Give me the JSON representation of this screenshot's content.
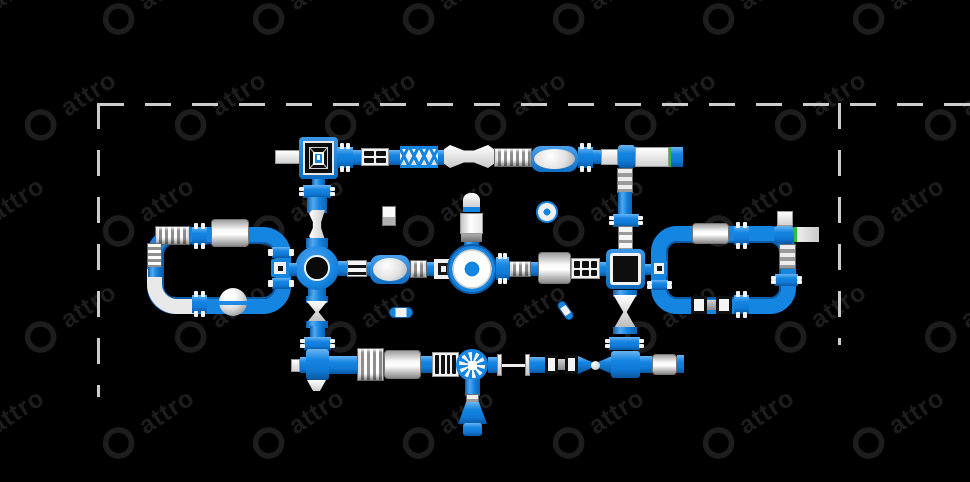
{
  "scene": {
    "width": 970,
    "height": 482,
    "background": "#000000"
  },
  "watermark": {
    "text": "attro",
    "logo_icon": "triskelion-swirl-logo",
    "color": "#1d1d1d",
    "angle_deg": -33,
    "cols": 8,
    "rows": 5,
    "tile_dx": 150,
    "tile_dy": 106,
    "row_stagger": 72,
    "start_x": -55,
    "start_y": -18,
    "font_size": 25,
    "logo_size": 36
  },
  "border": {
    "color": "#cccccc",
    "thickness": 3,
    "dash": 26,
    "gap": 21,
    "top": {
      "x": 98,
      "y": 103,
      "length": 872,
      "orientation": "h"
    },
    "left": {
      "x": 97,
      "y": 103,
      "length": 294,
      "orientation": "v"
    },
    "right": {
      "x": 838,
      "y": 103,
      "length": 242,
      "orientation": "v"
    }
  },
  "palette": {
    "blue": "#1585e2",
    "blue_dark": "#0c5ba6",
    "white": "#f2f2f2",
    "gray": "#9e9e9e",
    "black": "#000000",
    "green": "#2fbf3a"
  },
  "modules": [
    {
      "type": "loop-ring",
      "name": "left-loop-circuit",
      "x": 147,
      "y": 227,
      "w": 144,
      "h": 87,
      "r": 28
    },
    {
      "type": "elbow-white",
      "name": "left-loop-slide-elbow",
      "x": 147,
      "y": 262,
      "w": 48,
      "h": 52
    },
    {
      "type": "loop-ring",
      "name": "right-loop-circuit",
      "x": 651,
      "y": 226,
      "w": 145,
      "h": 88,
      "r": 26
    },
    {
      "type": "stub-v",
      "name": "platform-stub",
      "x": 312,
      "y": 178,
      "w": 13,
      "h": 8
    },
    {
      "type": "bumps-v",
      "name": "connector",
      "x": 303,
      "y": 185,
      "w": 28,
      "h": 13
    },
    {
      "type": "pipe-v",
      "name": "pipe",
      "x": 307,
      "y": 197,
      "w": 20,
      "h": 16
    },
    {
      "type": "bone-v",
      "name": "balance-beam",
      "x": 309,
      "y": 210,
      "w": 16,
      "h": 30
    },
    {
      "type": "pipe-v",
      "name": "pipe",
      "x": 306,
      "y": 238,
      "w": 22,
      "h": 10
    },
    {
      "type": "stub-v",
      "name": "ring-stub",
      "x": 308,
      "y": 288,
      "w": 18,
      "h": 9
    },
    {
      "type": "hourglass-v",
      "name": "twist-mini",
      "x": 306,
      "y": 296,
      "w": 22,
      "h": 32
    },
    {
      "type": "pipe-v",
      "name": "pipe",
      "x": 310,
      "y": 326,
      "w": 15,
      "h": 12
    },
    {
      "type": "bumps-v",
      "name": "connector",
      "x": 304,
      "y": 337,
      "w": 27,
      "h": 13
    },
    {
      "type": "wedge-gray",
      "name": "climb-wedge",
      "x": 617,
      "y": 168,
      "w": 16,
      "h": 25
    },
    {
      "type": "pipe-v",
      "name": "pipe",
      "x": 618,
      "y": 192,
      "w": 14,
      "h": 23
    },
    {
      "type": "bumps-v",
      "name": "connector",
      "x": 613,
      "y": 214,
      "w": 26,
      "h": 13
    },
    {
      "type": "rung-ladder",
      "name": "rung-ladder",
      "x": 618,
      "y": 226,
      "w": 15,
      "h": 26
    },
    {
      "type": "hourglass-v",
      "name": "twist-bridge",
      "x": 613,
      "y": 290,
      "w": 24,
      "h": 44
    },
    {
      "type": "bumps-v",
      "name": "connector",
      "x": 609,
      "y": 337,
      "w": 31,
      "h": 13
    },
    {
      "type": "white-box",
      "name": "exit-slide-left",
      "x": 275,
      "y": 150,
      "w": 27,
      "h": 14
    },
    {
      "type": "square-platform-net",
      "name": "climb-tower-platform",
      "x": 299,
      "y": 137,
      "w": 39,
      "h": 42
    },
    {
      "type": "bumps-h",
      "name": "connector",
      "x": 337,
      "y": 147,
      "w": 16,
      "h": 21
    },
    {
      "type": "pipe-h",
      "name": "pipe",
      "x": 353,
      "y": 150,
      "w": 8,
      "h": 15
    },
    {
      "type": "grid-box",
      "name": "ladder-2x2",
      "x": 361,
      "y": 148,
      "w": 28,
      "h": 18,
      "cols": 2,
      "rows": 2
    },
    {
      "type": "pipe-h",
      "name": "pipe",
      "x": 389,
      "y": 150,
      "w": 11,
      "h": 15
    },
    {
      "type": "truss-bridge",
      "name": "x-truss-bridge",
      "x": 400,
      "y": 146,
      "w": 38,
      "h": 22
    },
    {
      "type": "pipe-h",
      "name": "pipe",
      "x": 438,
      "y": 150,
      "w": 6,
      "h": 15
    },
    {
      "type": "bone-h",
      "name": "wave-beam",
      "x": 444,
      "y": 145,
      "w": 50,
      "h": 23
    },
    {
      "type": "striped-box",
      "name": "roller-stripes",
      "x": 494,
      "y": 148,
      "w": 38,
      "h": 19
    },
    {
      "type": "oval-pad",
      "name": "blob-pad",
      "x": 531,
      "y": 146,
      "w": 47,
      "h": 26
    },
    {
      "type": "bumps-h",
      "name": "connector",
      "x": 578,
      "y": 147,
      "w": 15,
      "h": 21
    },
    {
      "type": "pipe-h",
      "name": "pipe",
      "x": 593,
      "y": 150,
      "w": 8,
      "h": 14
    },
    {
      "type": "white-box",
      "name": "slide-wedge",
      "x": 601,
      "y": 149,
      "w": 17,
      "h": 16
    },
    {
      "type": "junction-square",
      "name": "junction-top-right",
      "x": 618,
      "y": 145,
      "w": 17,
      "h": 23
    },
    {
      "type": "white-box",
      "name": "runway-platform",
      "x": 635,
      "y": 147,
      "w": 34,
      "h": 20
    },
    {
      "type": "green-stripe",
      "name": "start-line",
      "x": 669,
      "y": 147,
      "w": 2,
      "h": 20
    },
    {
      "type": "pipe-h",
      "name": "pipe",
      "x": 671,
      "y": 147,
      "w": 12,
      "h": 20
    },
    {
      "type": "ring-junction",
      "name": "ring-junction",
      "x": 295,
      "y": 246,
      "w": 44,
      "h": 44
    },
    {
      "type": "pipe-h",
      "name": "pipe",
      "x": 338,
      "y": 261,
      "w": 9,
      "h": 15
    },
    {
      "type": "rail-box",
      "name": "double-rail",
      "x": 347,
      "y": 260,
      "w": 20,
      "h": 17
    },
    {
      "type": "pipe-h",
      "name": "pipe",
      "x": 367,
      "y": 262,
      "w": 5,
      "h": 14
    },
    {
      "type": "oval-pad",
      "name": "blob-pad-2",
      "x": 370,
      "y": 255,
      "w": 40,
      "h": 29
    },
    {
      "type": "striped-box",
      "name": "ladder-3",
      "x": 410,
      "y": 260,
      "w": 17,
      "h": 18
    },
    {
      "type": "pipe-h",
      "name": "pipe",
      "x": 427,
      "y": 262,
      "w": 7,
      "h": 14
    },
    {
      "type": "frame-box",
      "name": "square-frame",
      "x": 434,
      "y": 259,
      "w": 19,
      "h": 20
    },
    {
      "type": "pipe-h",
      "name": "pipe",
      "x": 453,
      "y": 262,
      "w": 6,
      "h": 14
    },
    {
      "type": "tower-v",
      "name": "slide-tower",
      "x": 460,
      "y": 193,
      "w": 23,
      "h": 62
    },
    {
      "type": "big-wheel-circle",
      "name": "round-spinner-platform",
      "x": 447,
      "y": 244,
      "w": 50,
      "h": 50
    },
    {
      "type": "bumps-h",
      "name": "connector",
      "x": 496,
      "y": 257,
      "w": 13,
      "h": 23
    },
    {
      "type": "striped-box",
      "name": "roller-small",
      "x": 509,
      "y": 261,
      "w": 22,
      "h": 16
    },
    {
      "type": "pipe-h",
      "name": "pipe",
      "x": 531,
      "y": 262,
      "w": 7,
      "h": 14
    },
    {
      "type": "cylinder-h",
      "name": "balance-roller",
      "x": 538,
      "y": 252,
      "w": 33,
      "h": 32
    },
    {
      "type": "grid-box",
      "name": "cargo-net-3x2",
      "x": 571,
      "y": 258,
      "w": 29,
      "h": 21,
      "cols": 3,
      "rows": 2
    },
    {
      "type": "pipe-h",
      "name": "pipe",
      "x": 600,
      "y": 262,
      "w": 7,
      "h": 14
    },
    {
      "type": "big-square-platform",
      "name": "square-platform",
      "x": 606,
      "y": 249,
      "w": 39,
      "h": 40
    },
    {
      "type": "pipe-h",
      "name": "pipe",
      "x": 645,
      "y": 264,
      "w": 7,
      "h": 11
    },
    {
      "type": "small-square-junction",
      "name": "mini-junction",
      "x": 651,
      "y": 260,
      "w": 16,
      "h": 17
    },
    {
      "type": "cylinder-h",
      "name": "roller",
      "x": 692,
      "y": 223,
      "w": 37,
      "h": 21
    },
    {
      "type": "bumps-h",
      "name": "connector",
      "x": 734,
      "y": 226,
      "w": 15,
      "h": 19
    },
    {
      "type": "white-box",
      "name": "entry-pad",
      "x": 777,
      "y": 211,
      "w": 16,
      "h": 15
    },
    {
      "type": "junction-square",
      "name": "junction-right-loop",
      "x": 774,
      "y": 226,
      "w": 20,
      "h": 18
    },
    {
      "type": "slide-green",
      "name": "exit-slide-right",
      "x": 794,
      "y": 227,
      "w": 25,
      "h": 15
    },
    {
      "type": "wedge-gray",
      "name": "climb-wedge",
      "x": 779,
      "y": 244,
      "w": 17,
      "h": 25
    },
    {
      "type": "bumps-v",
      "name": "connector",
      "x": 775,
      "y": 274,
      "w": 23,
      "h": 12
    },
    {
      "type": "bumps-h",
      "name": "connector",
      "x": 734,
      "y": 295,
      "w": 15,
      "h": 19
    },
    {
      "type": "paddles",
      "name": "hand-paddles",
      "x": 691,
      "y": 296,
      "w": 41,
      "h": 18
    },
    {
      "type": "bumps-v",
      "name": "connector",
      "x": 651,
      "y": 280,
      "w": 17,
      "h": 10
    },
    {
      "type": "striped-box",
      "name": "entry-steps",
      "x": 155,
      "y": 226,
      "w": 35,
      "h": 19
    },
    {
      "type": "striped-box-h",
      "name": "entry-steps-side",
      "x": 147,
      "y": 243,
      "w": 15,
      "h": 26
    },
    {
      "type": "pipe-v",
      "name": "pipe",
      "x": 148,
      "y": 267,
      "w": 14,
      "h": 10
    },
    {
      "type": "bumps-h",
      "name": "connector",
      "x": 192,
      "y": 227,
      "w": 15,
      "h": 18
    },
    {
      "type": "cylinder-h",
      "name": "roller-left",
      "x": 211,
      "y": 219,
      "w": 38,
      "h": 28
    },
    {
      "type": "bumps-h",
      "name": "connector",
      "x": 192,
      "y": 295,
      "w": 15,
      "h": 18
    },
    {
      "type": "sphere",
      "name": "balance-ball",
      "x": 219,
      "y": 288,
      "w": 28,
      "h": 28
    },
    {
      "type": "bumps-v",
      "name": "connector",
      "x": 272,
      "y": 247,
      "w": 18,
      "h": 11
    },
    {
      "type": "small-square-junction",
      "name": "mini-junction",
      "x": 271,
      "y": 259,
      "w": 18,
      "h": 18
    },
    {
      "type": "bumps-v",
      "name": "connector",
      "x": 272,
      "y": 278,
      "w": 18,
      "h": 11
    },
    {
      "type": "pipe-h",
      "name": "pipe",
      "x": 289,
      "y": 263,
      "w": 8,
      "h": 13
    },
    {
      "type": "white-box",
      "name": "end-cap",
      "x": 291,
      "y": 359,
      "w": 9,
      "h": 13
    },
    {
      "type": "pipe-h",
      "name": "pipe",
      "x": 300,
      "y": 357,
      "w": 7,
      "h": 16
    },
    {
      "type": "junction-square",
      "name": "cross-junction",
      "x": 306,
      "y": 349,
      "w": 23,
      "h": 31
    },
    {
      "type": "white-tip",
      "name": "slide-tip",
      "x": 307,
      "y": 380,
      "w": 19,
      "h": 11
    },
    {
      "type": "pipe-h",
      "name": "pipe",
      "x": 329,
      "y": 356,
      "w": 28,
      "h": 18
    },
    {
      "type": "striped-box",
      "name": "wide-roller",
      "x": 357,
      "y": 348,
      "w": 27,
      "h": 33
    },
    {
      "type": "cylinder-h",
      "name": "long-roller",
      "x": 384,
      "y": 350,
      "w": 37,
      "h": 29
    },
    {
      "type": "pipe-h",
      "name": "pipe",
      "x": 421,
      "y": 356,
      "w": 11,
      "h": 17
    },
    {
      "type": "grid-box",
      "name": "ladder-4",
      "x": 432,
      "y": 352,
      "w": 27,
      "h": 25,
      "cols": 4,
      "rows": 1
    },
    {
      "type": "wheel",
      "name": "water-wheel",
      "x": 456,
      "y": 349,
      "w": 32,
      "h": 32
    },
    {
      "type": "pipe-h",
      "name": "pipe",
      "x": 488,
      "y": 357,
      "w": 9,
      "h": 16
    },
    {
      "type": "monkey-bar",
      "name": "monkey-bar",
      "x": 497,
      "y": 354,
      "w": 33,
      "h": 22
    },
    {
      "type": "pipe-h",
      "name": "pipe",
      "x": 530,
      "y": 357,
      "w": 15,
      "h": 16
    },
    {
      "type": "paddles",
      "name": "hand-paddles",
      "x": 545,
      "y": 355,
      "w": 33,
      "h": 19
    },
    {
      "type": "pinch",
      "name": "pinch-connector",
      "x": 578,
      "y": 356,
      "w": 34,
      "h": 18
    },
    {
      "type": "junction-square",
      "name": "t-junction-bottom",
      "x": 611,
      "y": 351,
      "w": 29,
      "h": 27
    },
    {
      "type": "pipe-h",
      "name": "pipe",
      "x": 640,
      "y": 356,
      "w": 12,
      "h": 17
    },
    {
      "type": "cylinder-h",
      "name": "end-roller",
      "x": 652,
      "y": 354,
      "w": 25,
      "h": 21
    },
    {
      "type": "pipe-h",
      "name": "pipe",
      "x": 677,
      "y": 355,
      "w": 7,
      "h": 18
    },
    {
      "type": "pipe-v",
      "name": "pipe",
      "x": 465,
      "y": 379,
      "w": 15,
      "h": 17
    },
    {
      "type": "wedge-gray",
      "name": "slide-step",
      "x": 466,
      "y": 394,
      "w": 13,
      "h": 9
    },
    {
      "type": "flare-down",
      "name": "exit-flare",
      "x": 458,
      "y": 402,
      "w": 29,
      "h": 22
    },
    {
      "type": "junction-square",
      "name": "exit-pad",
      "x": 463,
      "y": 423,
      "w": 19,
      "h": 13
    },
    {
      "type": "cube",
      "name": "float-cube",
      "x": 382,
      "y": 206,
      "w": 14,
      "h": 20
    },
    {
      "type": "donut-small",
      "name": "float-donut",
      "x": 536,
      "y": 201,
      "w": 22,
      "h": 22
    },
    {
      "type": "pill-h",
      "name": "float-log",
      "x": 389,
      "y": 307,
      "w": 24,
      "h": 11
    },
    {
      "type": "pill-h",
      "name": "float-log",
      "x": 555,
      "y": 306,
      "w": 21,
      "h": 9,
      "rot": 55
    }
  ]
}
